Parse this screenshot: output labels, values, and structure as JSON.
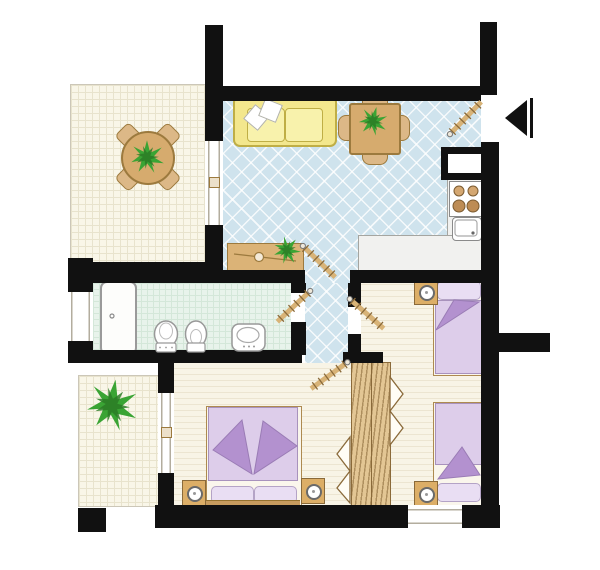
{
  "meta": {
    "kind": "apartment-floor-plan",
    "no_visible_text": true
  },
  "colors": {
    "wall": "#111111",
    "living_floor": "#cfe3ed",
    "terrace_floor": "#f9f6e8",
    "terrace_line": "#e8e3cd",
    "bath_floor": "#e8f3eb",
    "bath_line": "#d4e7d9",
    "bed_floor": "#f8f4e6",
    "bed_line": "#ece5d1",
    "wood": "#d6ab6e",
    "wood_dark": "#9c7a3e",
    "wood_light": "#e3c694",
    "sofa": "#f3e78d",
    "sofa_dark": "#bfae45",
    "sofa_light": "#f8f2ac",
    "counter": "#f1f1ef",
    "counter_line": "#a5a5a0",
    "lavender": "#ddcdea",
    "lavender_dark": "#a892bc",
    "lavender_light": "#e9def3",
    "purple": "#b391cf",
    "green": "#3aa434",
    "green_dark": "#2c7d26",
    "window_line": "#b3ad9e"
  },
  "rooms": {
    "terrace_main": "terrace-main",
    "living_room": "living-room",
    "kitchen": "kitchen-corner",
    "hallway": "hallway",
    "bathroom": "bathroom",
    "bedroom_double": "bedroom-double",
    "bedroom_twin": "bedroom-twin",
    "terrace_small": "terrace-small"
  },
  "fixtures": [
    "round-table",
    "terrace-chairs-x4",
    "potted-plant-x4",
    "sofa",
    "pillows-x2",
    "dining-table",
    "dining-chairs-x4",
    "sideboard",
    "entrance-arrow",
    "door-swing-x5",
    "kitchen-counter",
    "stove-4-burners",
    "kitchen-sink",
    "wall-niche",
    "shower-tray",
    "toilet",
    "bidet",
    "washbasin",
    "window-x4",
    "sliding-door",
    "double-bed",
    "single-bed-x2",
    "nightstand-x4",
    "open-wardrobe"
  ]
}
